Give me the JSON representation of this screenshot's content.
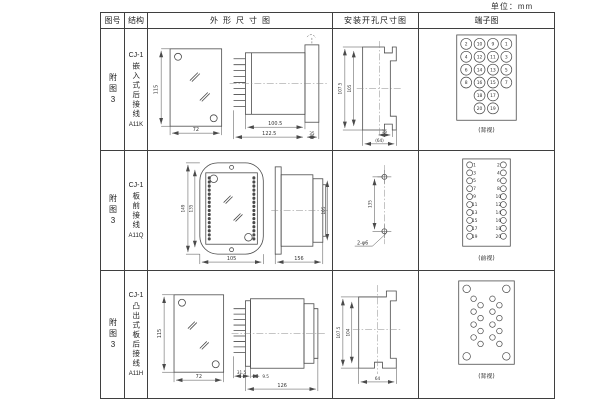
{
  "unit_label": "单位：mm",
  "header": {
    "figure": "图号",
    "structure": "结构",
    "outline": "外形尺寸图",
    "mounting": "安装开孔尺寸图",
    "terminal": "端子图"
  },
  "rows": [
    {
      "figure": "附图3",
      "model": "CJ-1",
      "desc": "嵌入式后接线",
      "code": "A11K",
      "outline": {
        "h": "115",
        "w": "72",
        "d1": "100.5",
        "d2": "122.5",
        "d3": "35"
      },
      "mounting": {
        "outer": "107.5",
        "inner": "105",
        "slot": "16",
        "overall": "(64)"
      },
      "terminal": {
        "view": "(背视)",
        "numbers": [
          [
            "2",
            "10",
            "9",
            "1"
          ],
          [
            "4",
            "12",
            "11",
            "3"
          ],
          [
            "6",
            "14",
            "13",
            "5"
          ],
          [
            "8",
            "16",
            "15",
            "7"
          ],
          [
            "18",
            "17"
          ],
          [
            "20",
            "19"
          ]
        ]
      }
    },
    {
      "figure": "附图3",
      "model": "CJ-1",
      "desc": "板前接线",
      "code": "A11Q",
      "outline": {
        "h": "149",
        "h2": "135",
        "w": "105",
        "d1": "156",
        "side_h": "105"
      },
      "mounting": {
        "spacing": "135",
        "holes": "2-φ6"
      },
      "terminal": {
        "view": "(前视)",
        "left": [
          "1",
          "3",
          "5",
          "7",
          "9",
          "11",
          "13",
          "15",
          "17",
          "19"
        ],
        "right": [
          "2",
          "4",
          "6",
          "8",
          "10",
          "12",
          "14",
          "16",
          "18",
          "20"
        ]
      }
    },
    {
      "figure": "附图3",
      "model": "CJ-1",
      "desc": "凸出式板后接线",
      "code": "A11H",
      "outline": {
        "h": "115",
        "w": "72",
        "d1": "31.5",
        "d2": "9.5",
        "d3": "126"
      },
      "mounting": {
        "outer": "107.5",
        "inner": "104",
        "overall": "64"
      },
      "terminal": {
        "view": "(背视)"
      }
    }
  ]
}
